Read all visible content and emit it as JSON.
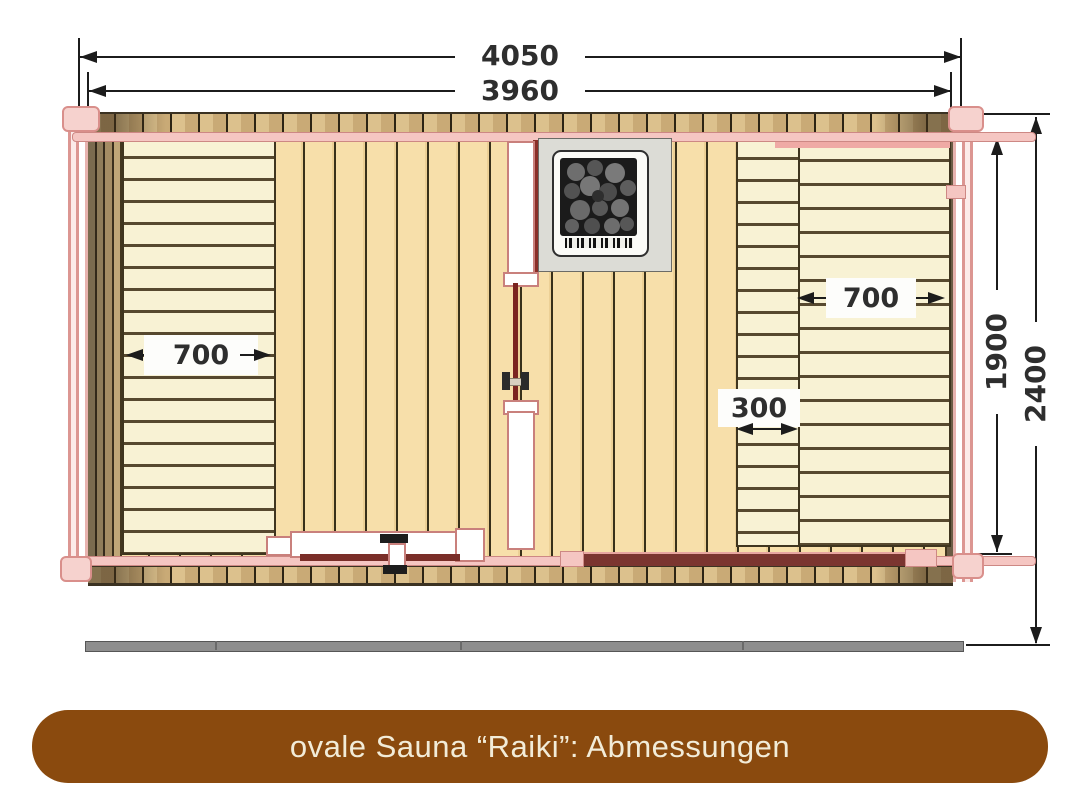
{
  "banner": {
    "label": "ovale Sauna “Raiki”: Abmessungen",
    "bg_color": "#8a4a0e",
    "text_color": "#f2ecd8"
  },
  "diagram": {
    "type": "floor-plan",
    "subject": "oval sauna Raiki, top view with dimensions (mm)",
    "dimensions": {
      "outer_length": "4050",
      "inner_length": "3960",
      "inner_width": "1900",
      "outer_width": "2400",
      "left_bench_depth": "700",
      "right_bench_depth": "700",
      "right_step_depth": "300"
    },
    "colors": {
      "outline_pink": "#d98f8b",
      "floor_tan": "#f7dfaa",
      "bench_cream": "#f8f2d4",
      "wall_brown": "#8f7c5a",
      "heater_gray": "#dcdcd6",
      "skid_gray": "#8e8e8e",
      "dimension_ink": "#1c1c1c"
    },
    "icons": {
      "heater": "sauna-heater-stones-icon",
      "door_handle": "door-handle-icon"
    }
  }
}
